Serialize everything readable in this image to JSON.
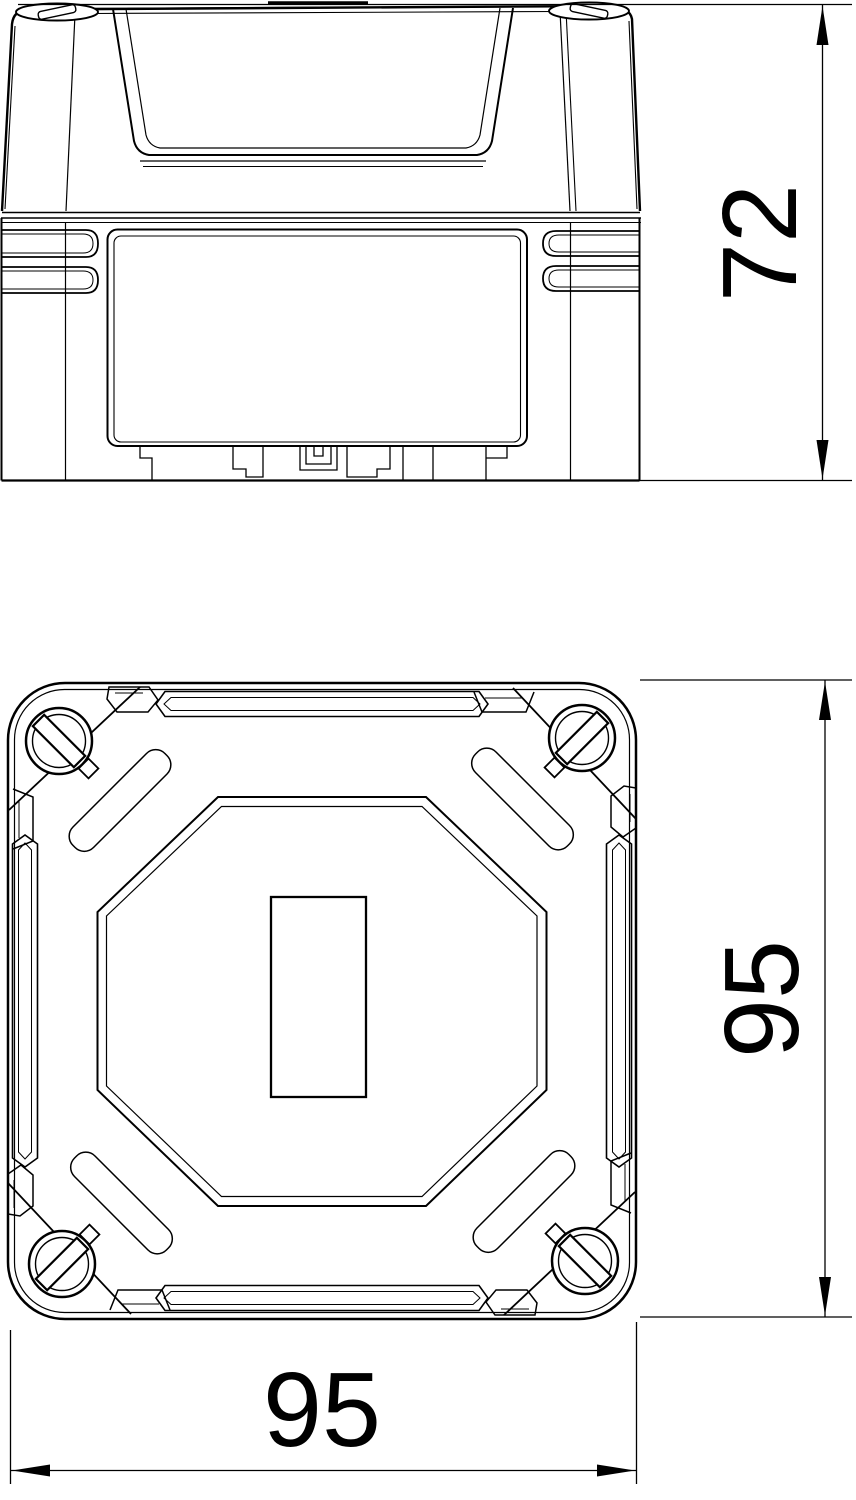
{
  "page": {
    "background_color": "#ffffff",
    "line_color": "#000000",
    "content_type": "technical dimension drawing, junction box, two orthographic views"
  },
  "drawing": {
    "dimensions": {
      "side_height": {
        "value": "72",
        "orientation": "vertical",
        "view": "side-elevation"
      },
      "plan_depth": {
        "value": "95",
        "orientation": "vertical",
        "view": "top-plan"
      },
      "plan_width": {
        "value": "95",
        "orientation": "horizontal",
        "view": "top-plan"
      }
    }
  }
}
